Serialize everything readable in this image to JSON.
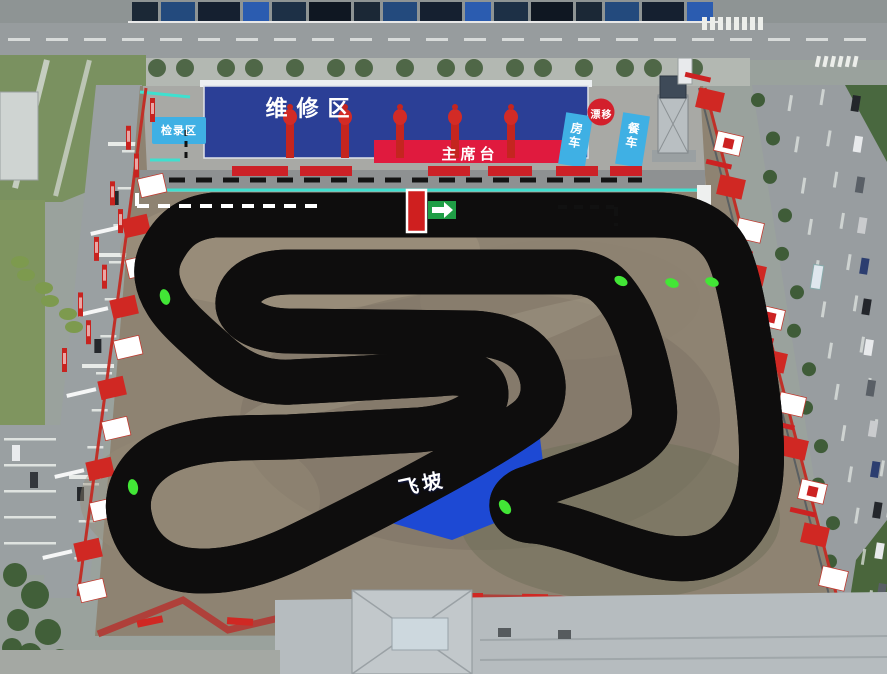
{
  "labels": {
    "pit_area": "维修区",
    "checkin_area": "检录区",
    "main_stage": "主席台",
    "drift_zone": "漂移",
    "rv_parking": "房车",
    "food_truck": "餐车",
    "jump_ramp": "飞坡"
  },
  "colors": {
    "track_pink": "#fa28a2",
    "track_outline": "#0e0d0d",
    "pit_blue": "#2b3f96",
    "info_blue": "#3fb0e4",
    "stage_red": "#e01a3e",
    "barrier_red": "#d02823",
    "jump_blue": "#1d49d4",
    "marker_green": "#42e636",
    "boundary_cyan": "#3fe0cf",
    "start_red": "#cf1f1f",
    "arrow_green": "#1f9e45"
  }
}
